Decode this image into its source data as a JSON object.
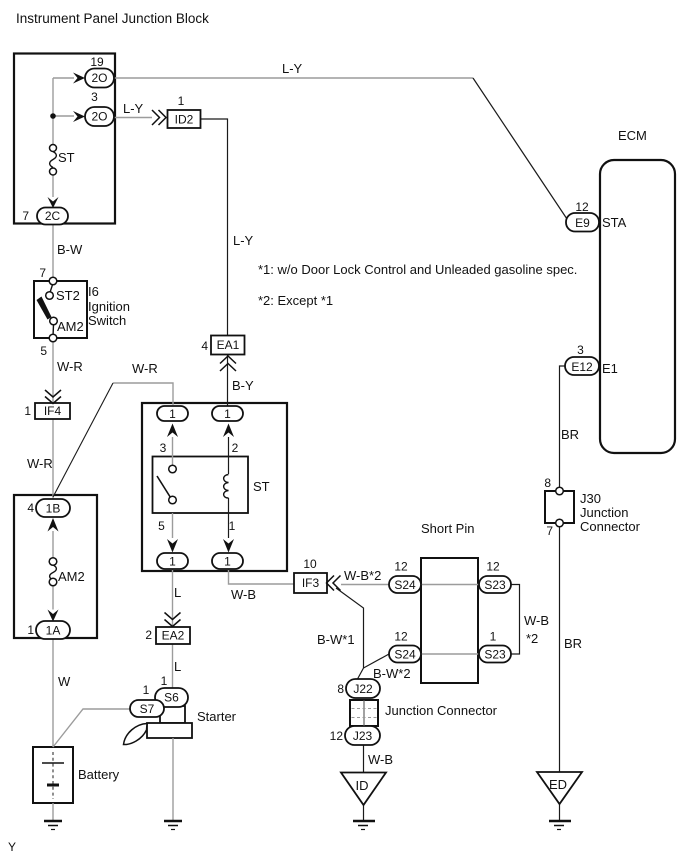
{
  "title": "Instrument Panel Junction Block",
  "page_marker": "Y",
  "notes": {
    "n1": "*1: w/o Door Lock Control and Unleaded gasoline spec.",
    "n2": "*2: Except *1"
  },
  "colors": {
    "wire_gray": "#9c9c9c",
    "line_black": "#1a1a1a",
    "background": "#ffffff"
  },
  "labels": {
    "ecm": "ECM",
    "sta": "STA",
    "e1": "E1",
    "short_pin": "Short Pin",
    "junction_connector": "Junction Connector",
    "j30_line1": "J30",
    "j30_line2": "Junction",
    "j30_line3": "Connector",
    "battery": "Battery",
    "starter": "Starter",
    "ignition_ref": "I6",
    "ignition_line1": "Ignition",
    "ignition_line2": "Switch",
    "terminal_st2": "ST2",
    "terminal_am2": "AM2",
    "fuse_st": "ST",
    "fuse_am2": "AM2",
    "relay_st": "ST",
    "ground_id": "ID",
    "ground_ed": "ED"
  },
  "connectors": {
    "jb_2o_19": {
      "pin": "19",
      "name": "2O"
    },
    "jb_2o_3": {
      "pin": "3",
      "name": "2O"
    },
    "jb_2c": {
      "pin": "7",
      "name": "2C"
    },
    "id2": {
      "pin": "1",
      "name": "ID2"
    },
    "ea1": {
      "pin": "4",
      "name": "EA1"
    },
    "if4": {
      "pin": "1",
      "name": "IF4"
    },
    "ea2": {
      "pin": "2",
      "name": "EA2"
    },
    "if3": {
      "pin": "10",
      "name": "IF3"
    },
    "jb_1b": {
      "pin": "4",
      "name": "1B"
    },
    "jb_1a": {
      "pin": "1",
      "name": "1A"
    },
    "relay_top_left": {
      "name": "1"
    },
    "relay_top_right": {
      "name": "1"
    },
    "relay_bottom_left": {
      "name": "1"
    },
    "relay_bottom_right": {
      "name": "1"
    },
    "s6": {
      "pin": "1",
      "name": "S6"
    },
    "s7": {
      "pin": "1",
      "name": "S7"
    },
    "s24_top": {
      "pin": "12",
      "name": "S24"
    },
    "s23_top": {
      "pin": "12",
      "name": "S23"
    },
    "s24_bottom": {
      "pin": "12",
      "name": "S24"
    },
    "s23_bottom": {
      "pin": "1",
      "name": "S23"
    },
    "j22": {
      "pin": "8",
      "name": "J22"
    },
    "j23": {
      "pin": "12",
      "name": "J23"
    },
    "j30": {
      "pin_top": "8",
      "pin_bottom": "7"
    },
    "e9": {
      "pin": "12",
      "name": "E9"
    },
    "e12": {
      "pin": "3",
      "name": "E12"
    }
  },
  "relay_pins": {
    "p3": "3",
    "p2": "2",
    "p5": "5",
    "p1": "1"
  },
  "ignition_pins": {
    "top": "7",
    "bottom": "5"
  },
  "wire_labels": {
    "ly_top": "L-Y",
    "ly_to_id2": "L-Y",
    "ly_mid": "L-Y",
    "bw": "B-W",
    "wr_below_switch": "W-R",
    "wr_below_if4": "W-R",
    "wr_branch": "W-R",
    "by": "B-Y",
    "w": "W",
    "l_relay": "L",
    "l_starter": "L",
    "wb_relay": "W-B",
    "wb2_if3": "W-B*2",
    "bw1": "B-W*1",
    "bw2": "B-W*2",
    "wb_ground": "W-B",
    "wb_right_line1": "W-B",
    "wb_right_line2": "*2",
    "br_upper": "BR",
    "br_lower": "BR"
  }
}
